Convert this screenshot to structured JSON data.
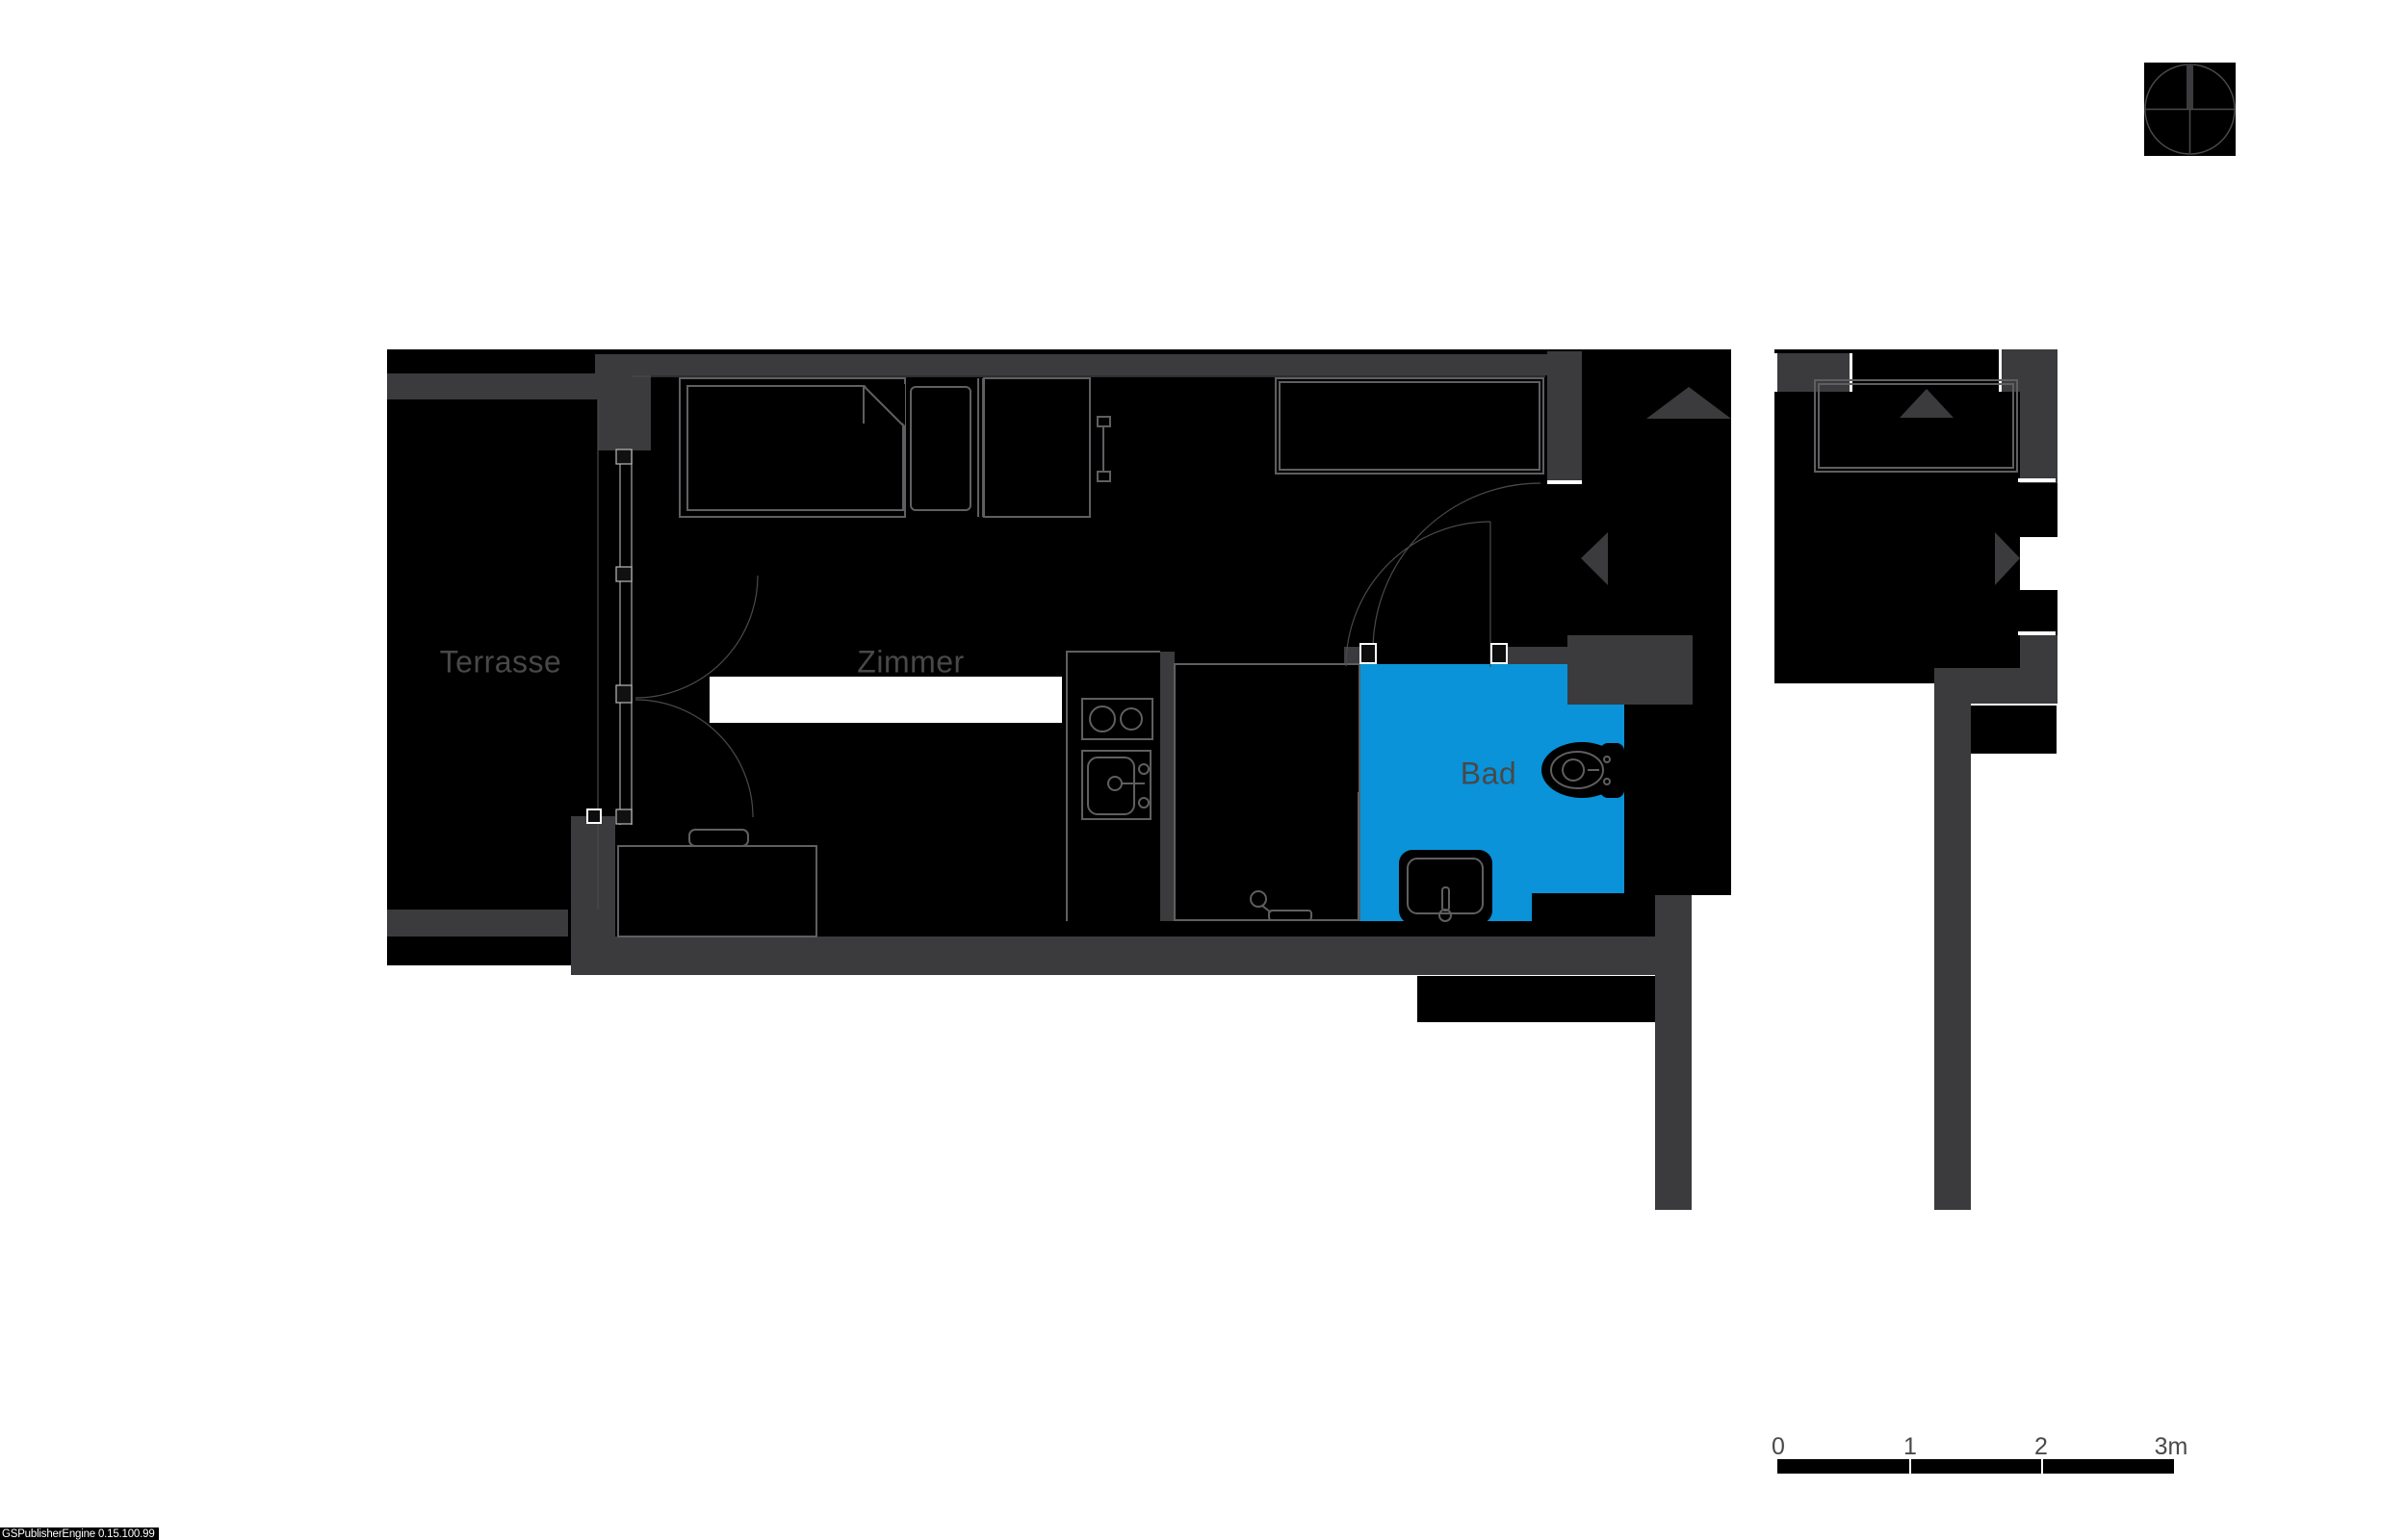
{
  "plan": {
    "type": "apartment-floor-plan",
    "rooms": [
      {
        "id": "terrasse",
        "label": "Terrasse",
        "highlighted": false
      },
      {
        "id": "zimmer",
        "label": "Zimmer",
        "highlighted": false
      },
      {
        "id": "bad",
        "label": "Bad",
        "highlighted": true
      }
    ],
    "fixtures": [
      "bed",
      "pillow",
      "dresser",
      "wardrobe",
      "desk",
      "chair",
      "dining-table",
      "kitchen-cooktop",
      "kitchen-sink",
      "shower",
      "washbasin",
      "toilet",
      "terrace-double-door",
      "entry-door",
      "bath-door"
    ],
    "icons": [
      "north-indicator-icon",
      "entry-arrow-up-icon",
      "entry-arrow-left-icon",
      "entry-arrow-up-icon-2",
      "entry-arrow-right-icon"
    ]
  },
  "scale_bar": {
    "ticks": [
      "0",
      "1",
      "2",
      "3m"
    ],
    "segments": 3
  },
  "watermark": {
    "text": "GSPublisherEngine 0.15.100.99"
  },
  "colors": {
    "background": "#ffffff",
    "interior": "#000000",
    "wall": "#3b3b3d",
    "highlight": "#0a93d8",
    "line": "#5f5f62",
    "label": "#48484a",
    "scale_text": "#4a4a4c",
    "watermark_bg": "#000000",
    "watermark_text": "#ffffff"
  }
}
